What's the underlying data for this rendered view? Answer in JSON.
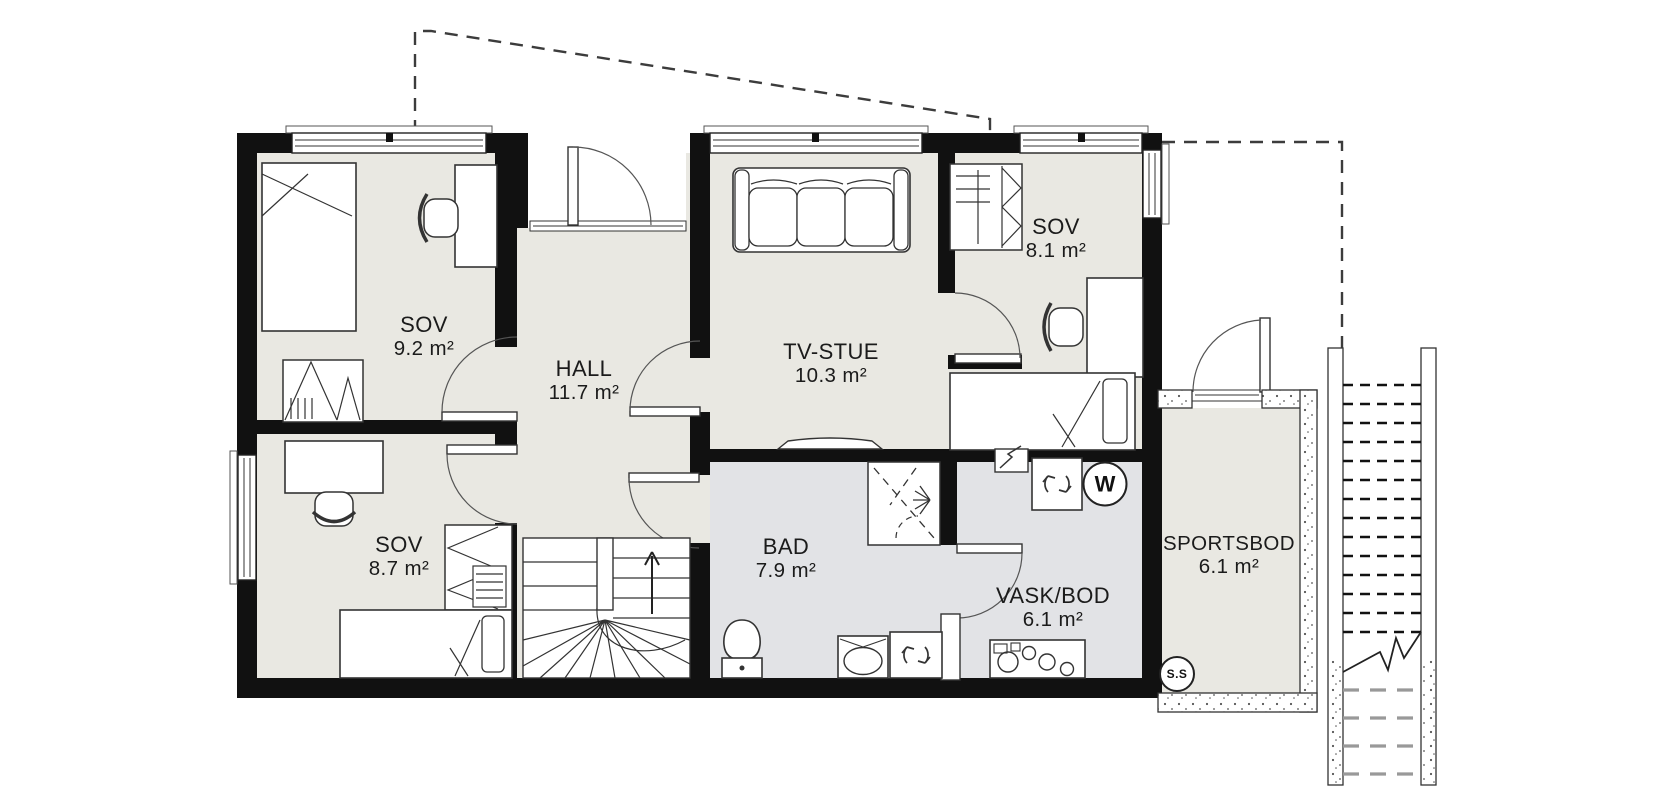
{
  "rooms": {
    "sov_top_left": {
      "name": "SOV",
      "area": "9.2 m²"
    },
    "hall": {
      "name": "HALL",
      "area": "11.7 m²"
    },
    "tv_stue": {
      "name": "TV-STUE",
      "area": "10.3 m²"
    },
    "sov_top_right": {
      "name": "SOV",
      "area": "8.1 m²"
    },
    "sov_bottom_left": {
      "name": "SOV",
      "area": "8.7 m²"
    },
    "bad": {
      "name": "BAD",
      "area": "7.9 m²"
    },
    "vask_bod": {
      "name": "VASK/BOD",
      "area": "6.1 m²"
    },
    "sportsbod": {
      "name": "SPORTSBOD",
      "area": "6.1 m²"
    }
  },
  "badges": {
    "stair_symbol": "S.S",
    "washing_machine_symbol": "W"
  },
  "colors": {
    "wall": "#111111",
    "room_floor": "#e9e8e2",
    "wet_room_floor": "#e2e3e6",
    "line": "#333333"
  }
}
